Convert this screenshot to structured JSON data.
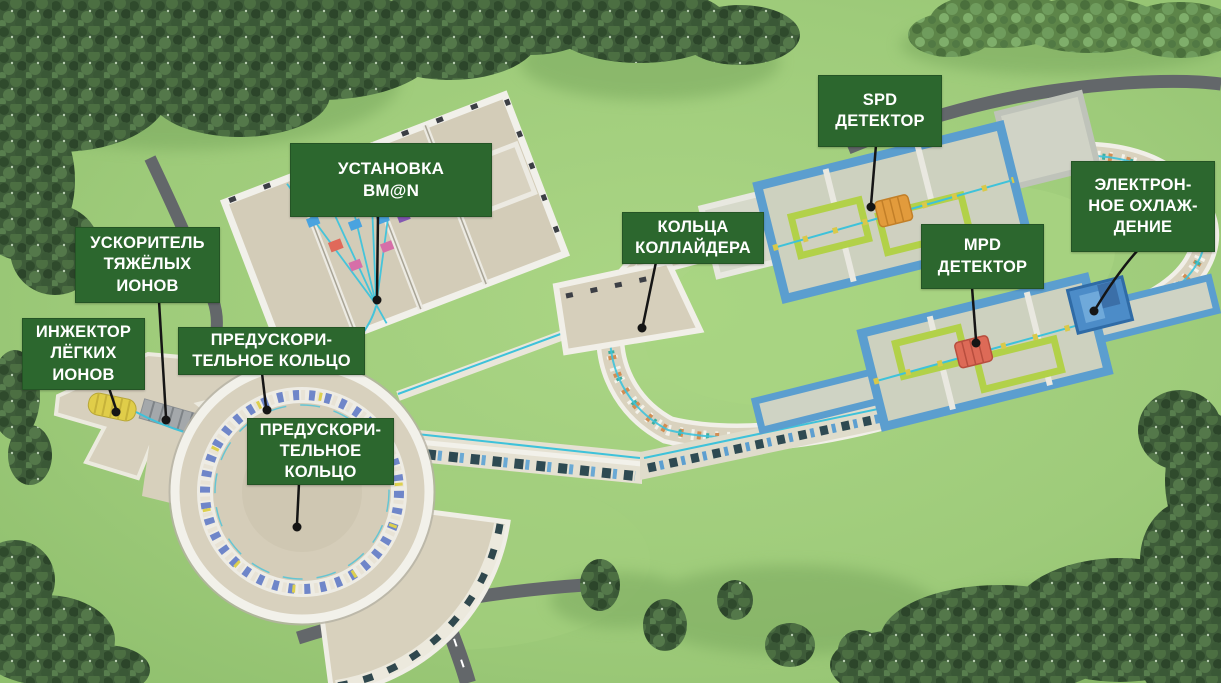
{
  "labels": [
    {
      "id": "bmn-facility",
      "text": "УСТАНОВКА\nBM@N"
    },
    {
      "id": "spd-detector",
      "text": "SPD\nДЕТЕКТОР"
    },
    {
      "id": "electron-cooling",
      "text": "ЭЛЕКТРОН-\nНОЕ ОХЛАЖ-\nДЕНИЕ"
    },
    {
      "id": "collider-rings",
      "text": "КОЛЬЦА\nКОЛЛАЙДЕРА"
    },
    {
      "id": "mpd-detector",
      "text": "MPD\nДЕТЕКТОР"
    },
    {
      "id": "heavy-ion-accelerator",
      "text": "УСКОРИТЕЛЬ\nТЯЖЁЛЫХ\nИОНОВ"
    },
    {
      "id": "light-ion-injector",
      "text": "ИНЖЕКТОР\nЛЁГКИХ\nИОНОВ"
    },
    {
      "id": "booster-ring-upper",
      "text": "ПРЕДУСКОРИ-\nТЕЛЬНОЕ КОЛЬЦО"
    },
    {
      "id": "booster-ring-lower",
      "text": "ПРЕДУСКОРИ-\nТЕЛЬНОЕ\nКОЛЬЦО"
    }
  ],
  "colors": {
    "label_bg": "#2c672e",
    "label_text": "#ffffff",
    "grass": "#9ecb7a",
    "tree_dark": "#3e5c39",
    "tree_light": "#5d8549",
    "road": "#63676a",
    "building_floor": "#d6cfbb",
    "wall_white": "#f1efe8",
    "wall_blue": "#5b9ecf",
    "enclosure_lime": "#b2d149",
    "beamline_cyan": "#3ec2da",
    "booster_magnet_blue": "#6f86c9",
    "collider_magnet_orange": "#d28d52",
    "collider_magnet_teal": "#3fae9f",
    "spd_detector": "#e29b3c",
    "mpd_detector": "#dd6a57",
    "electron_cooler": "#4c8cc8",
    "light_ion_injector": "#e0cd49",
    "heavy_ion_linac": "#a4a8ab",
    "leader_line": "#151515"
  }
}
